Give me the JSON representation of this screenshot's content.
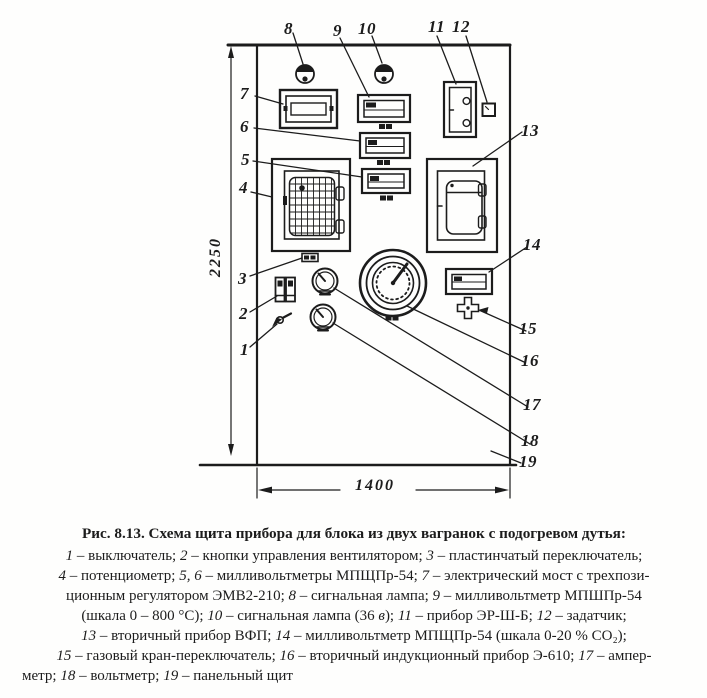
{
  "colors": {
    "ink": "#1c1c1c",
    "paper": "#fefefd"
  },
  "dims": {
    "height": "2250",
    "width": "1400"
  },
  "callouts": {
    "c1": "1",
    "c2": "2",
    "c3": "3",
    "c4": "4",
    "c5": "5",
    "c6": "6",
    "c7": "7",
    "c8": "8",
    "c9": "9",
    "c10": "10",
    "c11": "11",
    "c12": "12",
    "c13": "13",
    "c14": "14",
    "c15": "15",
    "c16": "16",
    "c17": "17",
    "c18": "18",
    "c19": "19"
  },
  "caption": {
    "title": "Рис. 8.13. Схема щита прибора для блока из двух вагранок с подогревом дутья:",
    "lines": [
      [
        {
          "t": "1",
          "i": 1
        },
        {
          "t": " – выключатель; "
        },
        {
          "t": "2",
          "i": 1
        },
        {
          "t": " – кнопки управления вентилятором; "
        },
        {
          "t": "3",
          "i": 1
        },
        {
          "t": " – пластинчатый переключатель;"
        }
      ],
      [
        {
          "t": "4",
          "i": 1
        },
        {
          "t": " – потенциометр; "
        },
        {
          "t": "5, 6",
          "i": 1
        },
        {
          "t": " – милливольтметры МПЩПр-54; "
        },
        {
          "t": "7",
          "i": 1
        },
        {
          "t": " – электрический мост с трехпози-"
        }
      ],
      [
        {
          "t": "ционным регулятором ЭМВ2-210; "
        },
        {
          "t": "8",
          "i": 1
        },
        {
          "t": " – сигнальная лампа; "
        },
        {
          "t": "9",
          "i": 1
        },
        {
          "t": " – милливольтметр МПШПр-54"
        }
      ],
      [
        {
          "t": "(шкала 0 – 800 °С); "
        },
        {
          "t": "10",
          "i": 1
        },
        {
          "t": " –  сигнальная лампа (36 "
        },
        {
          "t": "в",
          "i": 1
        },
        {
          "t": "); "
        },
        {
          "t": "11",
          "i": 1
        },
        {
          "t": " – прибор ЭР-Ш-Б; "
        },
        {
          "t": "12",
          "i": 1
        },
        {
          "t": " – задатчик;"
        }
      ],
      [
        {
          "t": "13",
          "i": 1
        },
        {
          "t": " – вторичный прибор ВФП; "
        },
        {
          "t": "14",
          "i": 1
        },
        {
          "t": " – милливольтметр МПЩПр-54 (шкала 0-20 % СО₂);"
        }
      ],
      [
        {
          "t": "15",
          "i": 1
        },
        {
          "t": " – газовый кран-переключатель; "
        },
        {
          "t": "16",
          "i": 1
        },
        {
          "t": " – вторичный индукционный прибор Э-610; "
        },
        {
          "t": "17",
          "i": 1
        },
        {
          "t": " – ампер-"
        }
      ],
      [
        {
          "t": "метр; "
        },
        {
          "t": "18",
          "i": 1
        },
        {
          "t": " – вольтметр;  "
        },
        {
          "t": "19",
          "i": 1
        },
        {
          "t": " – панельный щит"
        }
      ]
    ]
  }
}
